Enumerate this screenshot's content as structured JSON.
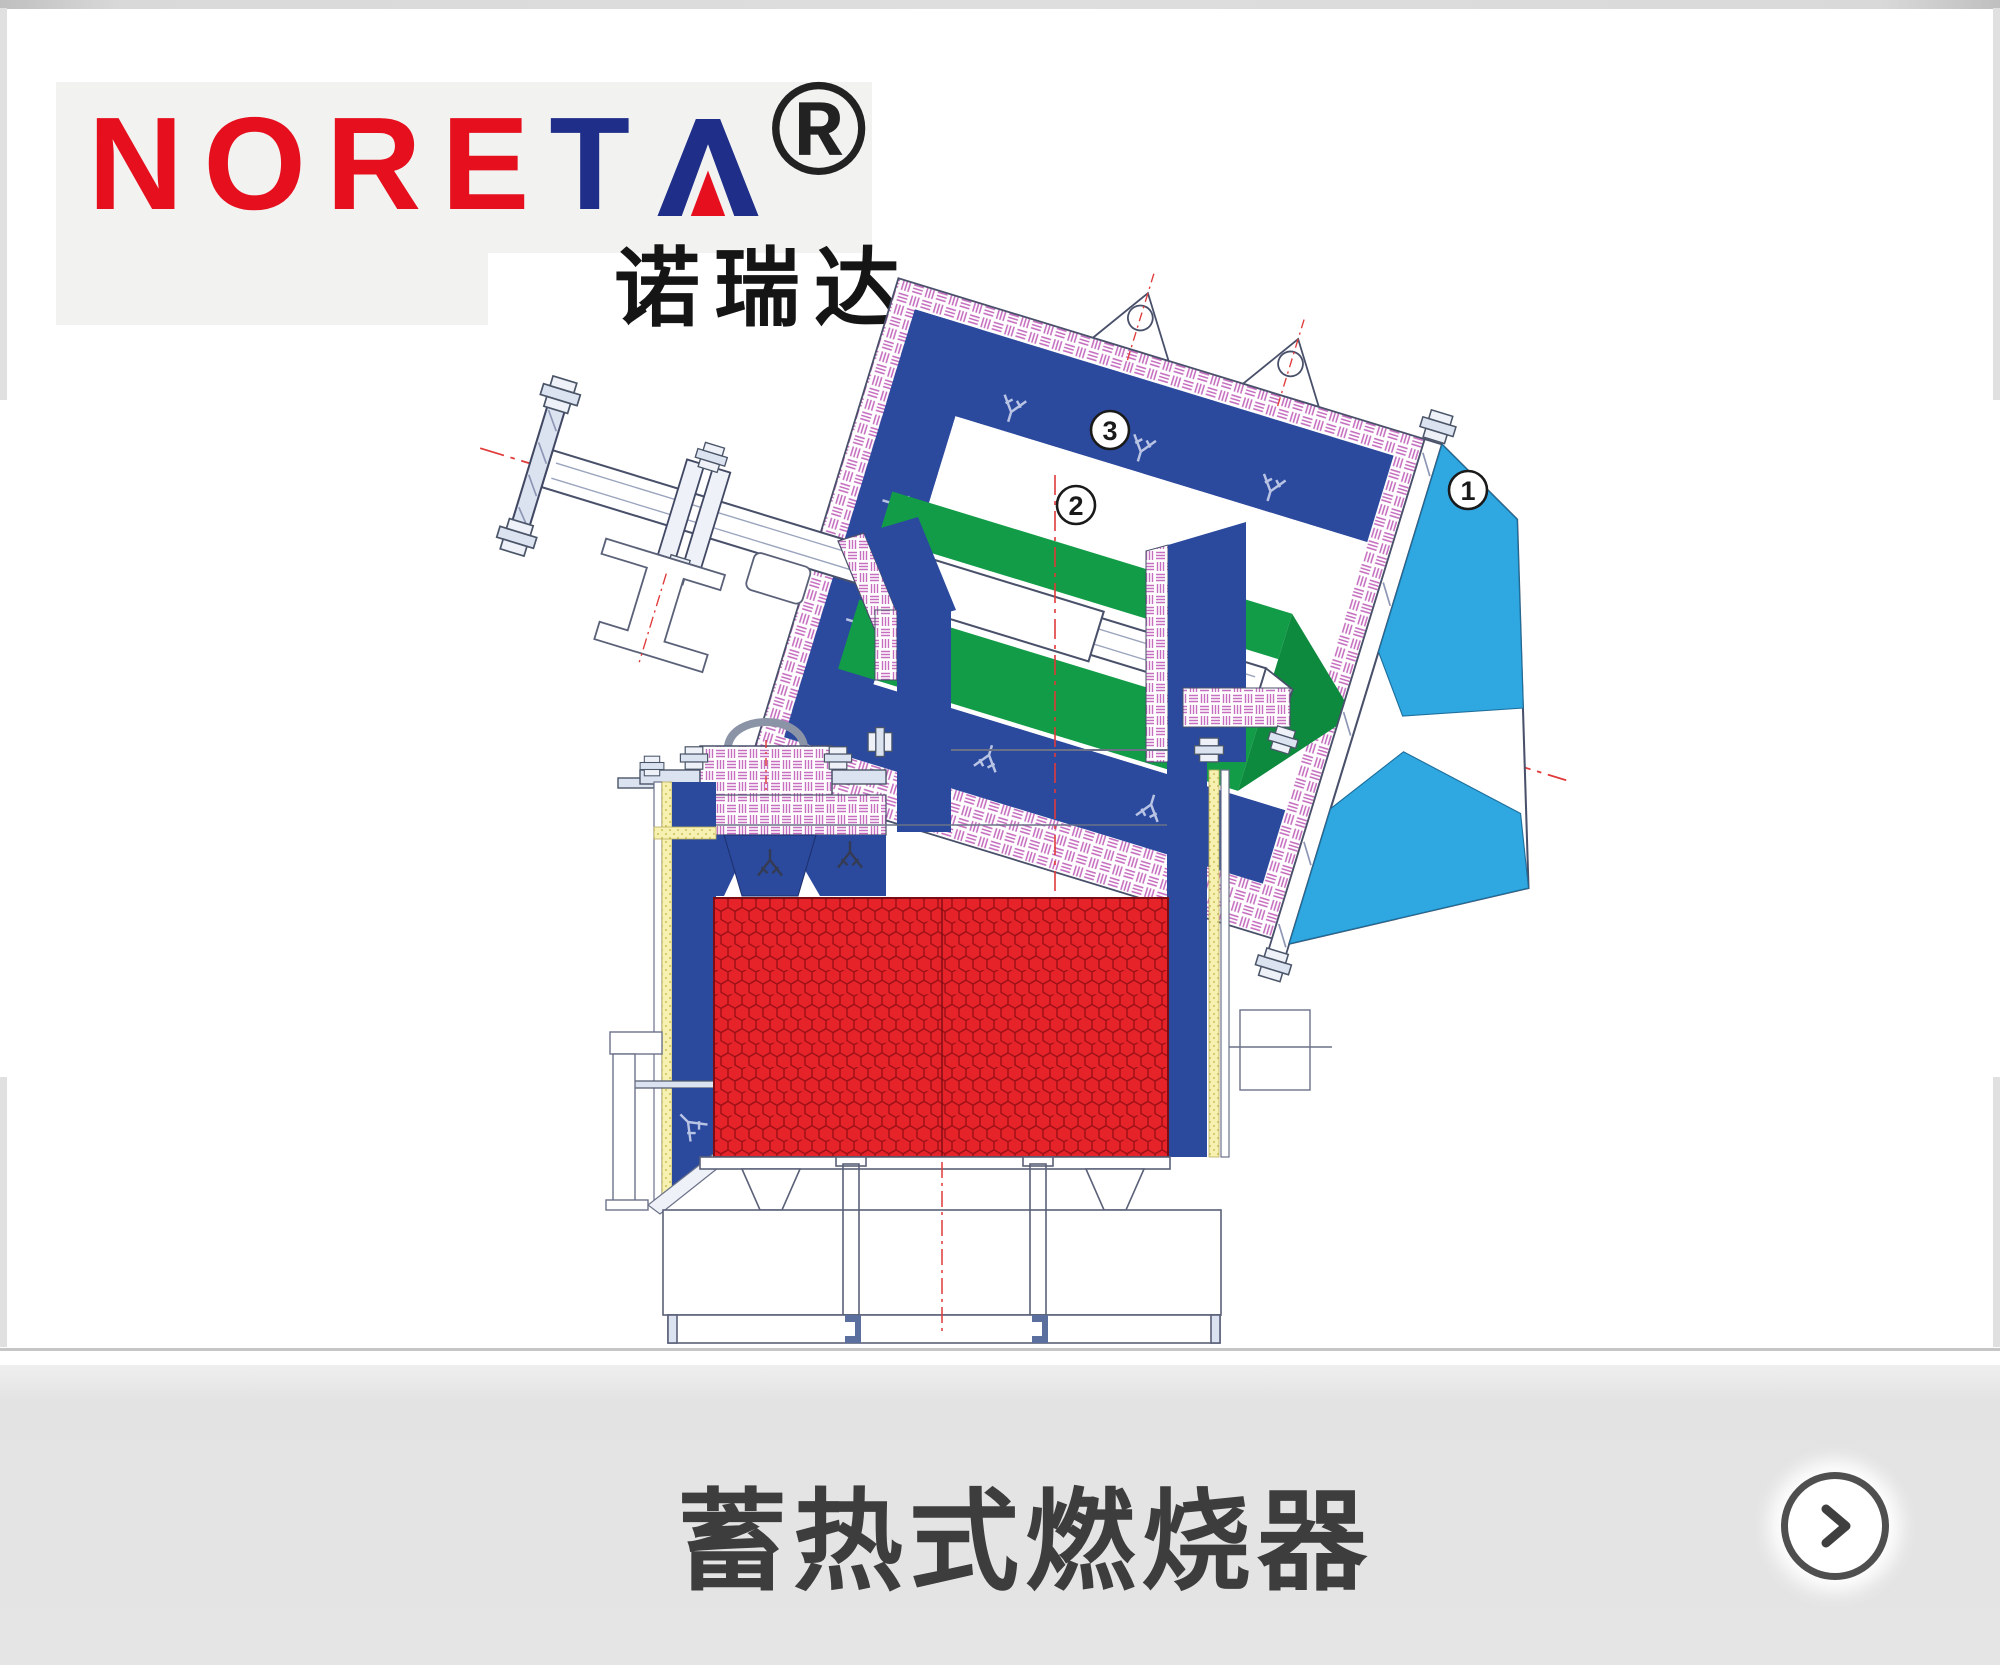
{
  "brand": {
    "wordmark_red": "NORE",
    "wordmark_blue_t": "T",
    "wordmark_blue_a": "A",
    "registered": "®",
    "chinese_name": "诺瑞达"
  },
  "diagram": {
    "type": "technical-cross-section",
    "subject": "regenerative burner",
    "callouts": [
      {
        "num": "1",
        "marker": "circled-number",
        "points_to": "air-nozzle-block"
      },
      {
        "num": "2",
        "marker": "circled-number",
        "points_to": "gas-duct"
      },
      {
        "num": "3",
        "marker": "circled-number",
        "points_to": "burner-casing"
      }
    ],
    "colors": {
      "casing_blue": "#2b4a9e",
      "duct_green": "#139c48",
      "nozzle_lightblue": "#2fa8e2",
      "honeycomb_red": "#e7232a",
      "honeycomb_line": "#9c1016",
      "insulation_pink": "#c66fc0",
      "insulation_yellow": "#f6f1b0",
      "centerline_red": "#e03a3a",
      "outline_gray": "#49506a"
    }
  },
  "footer": {
    "title": "蓄热式燃烧器",
    "next_icon": "chevron-right"
  }
}
